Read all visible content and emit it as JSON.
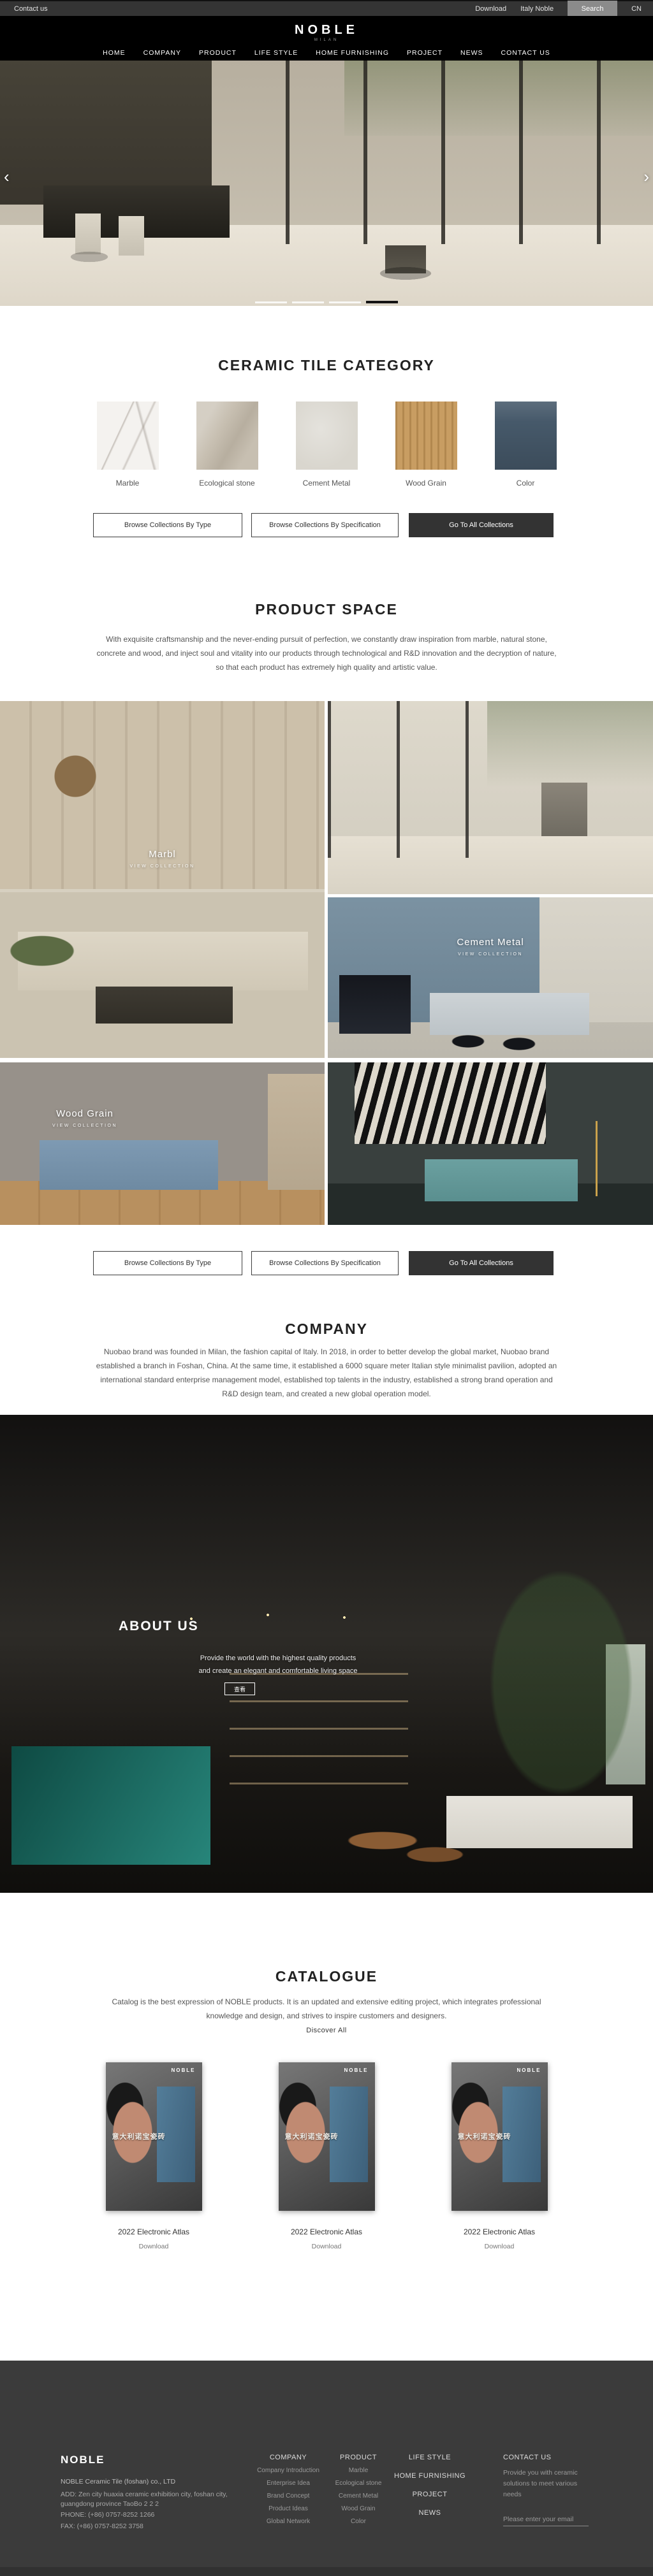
{
  "topbar": {
    "contact_us": "Contact us",
    "download": "Download",
    "italy_noble": "Italy Noble",
    "search": "Search",
    "language": "CN"
  },
  "header": {
    "logo": "NOBLE",
    "logo_subtitle": "MILAN",
    "nav": [
      {
        "label": "HOME"
      },
      {
        "label": "COMPANY"
      },
      {
        "label": "PRODUCT"
      },
      {
        "label": "LIFE STYLE"
      },
      {
        "label": "HOME FURNISHING"
      },
      {
        "label": "PROJECT"
      },
      {
        "label": "NEWS"
      },
      {
        "label": "CONTACT US"
      }
    ]
  },
  "hero": {
    "prev_arrow": "‹",
    "next_arrow": "›",
    "slide_count": 4,
    "active_slide": 4
  },
  "category": {
    "title": "CERAMIC TILE CATEGORY",
    "tiles": [
      {
        "label": "Marble",
        "color": "#f4f2ef"
      },
      {
        "label": "Ecological stone",
        "color": "#c7bfb1"
      },
      {
        "label": "Cement Metal",
        "color": "#d9d6ce"
      },
      {
        "label": "Wood Grain",
        "color": "#c89d62"
      },
      {
        "label": "Color",
        "color": "#46596a"
      }
    ]
  },
  "collection_buttons": [
    {
      "label": "Browse Collections By Type"
    },
    {
      "label": "Browse Collections By Specification"
    },
    {
      "label": "Go To All Collections"
    }
  ],
  "product_space": {
    "title": "PRODUCT SPACE",
    "description": "With exquisite craftsmanship and the never-ending pursuit of perfection, we constantly draw inspiration from marble, natural stone, concrete and wood, and inject soul and vitality into our products through technological and R&D innovation and the decryption of nature, so that each product has extremely high quality and artistic value.",
    "cards": [
      {
        "label": "Marbl",
        "sub": "VIEW COLLECTION"
      },
      {
        "label": "Cement Metal",
        "sub": "VIEW COLLECTION"
      },
      {
        "label": "Wood Grain",
        "sub": "VIEW COLLECTION"
      }
    ]
  },
  "company": {
    "title": "COMPANY",
    "description": "Nuobao brand was founded in Milan, the fashion capital of Italy. In 2018, in order to better develop the global market, Nuobao brand established a branch in Foshan, China. At the same time, it established a 6000 square meter Italian style minimalist pavilion, adopted an international standard enterprise management model, established top talents in the industry, established a strong brand operation and R&D design team, and created a new global operation model."
  },
  "about": {
    "title": "ABOUT US",
    "line1": "Provide the world with the highest quality products",
    "line2": "and create an elegant and comfortable living space",
    "button": "查看"
  },
  "catalogue": {
    "title": "CATALOGUE",
    "description": "Catalog is the best expression of NOBLE products. It is an updated and extensive editing project, which integrates professional knowledge and design, and strives to inspire customers and designers.",
    "discover": "Discover All",
    "cover": {
      "brand": "NOBLE",
      "headline": "意大利诺宝瓷砖"
    },
    "items": [
      {
        "title": "2022 Electronic Atlas",
        "action": "Download"
      },
      {
        "title": "2022 Electronic Atlas",
        "action": "Download"
      },
      {
        "title": "2022 Electronic Atlas",
        "action": "Download"
      }
    ]
  },
  "footer": {
    "brand": "NOBLE",
    "company_name": "NOBLE Ceramic Tile (foshan) co., LTD",
    "address": "ADD:  Zen city huaxia ceramic exhibition city, foshan city, guangdong province TaoBo 2 2 2",
    "phone": "PHONE:   (+86)  0757-8252 1266",
    "fax": "FAX:   (+86)  0757-8252 3758",
    "columns": [
      {
        "title": "COMPANY",
        "links": [
          "Company Introduction",
          "Enterprise Idea",
          "Brand Concept",
          "Product Ideas",
          "Global Network"
        ]
      },
      {
        "title": "PRODUCT",
        "links": [
          "Marble",
          "Ecological stone",
          "Cement Metal",
          "Wood Grain",
          "Color"
        ]
      }
    ],
    "nav_stack": [
      "LIFE STYLE",
      "HOME FURNISHING",
      "PROJECT",
      "NEWS"
    ],
    "contact": {
      "title": "CONTACT US",
      "text": "Provide you with ceramic solutions to meet various needs",
      "email_placeholder": "Please enter your email"
    }
  },
  "colors": {
    "topbar": "#343434",
    "header": "#000000",
    "button_dark": "#333333",
    "footer": "#3b3b3b",
    "catalog_blue": "#49708e"
  }
}
